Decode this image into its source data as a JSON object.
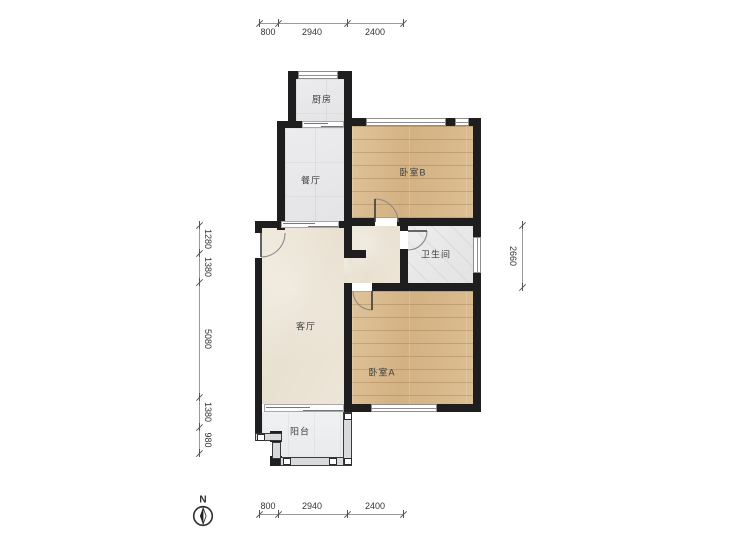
{
  "plan": {
    "rooms": {
      "kitchen": "厨房",
      "dining": "餐厅",
      "bedroom_b": "卧室B",
      "bathroom": "卫生间",
      "living": "客厅",
      "bedroom_a": "卧室A",
      "balcony": "阳台"
    },
    "dimensions": {
      "top": [
        "800",
        "2940",
        "2400"
      ],
      "bottom": [
        "800",
        "2940",
        "2400"
      ],
      "left": [
        "1280",
        "1380",
        "5080",
        "1380",
        "980"
      ],
      "right": [
        "2660"
      ]
    },
    "compass": {
      "north_label": "N"
    },
    "colors": {
      "wall": "#1e1e1e",
      "wood_floor": "#d8b88c",
      "tile_floor": "#e8e8ea",
      "living_floor": "#ebe4d6",
      "bath_floor": "#e9e9e9",
      "balcony_floor": "#eceef0"
    }
  }
}
